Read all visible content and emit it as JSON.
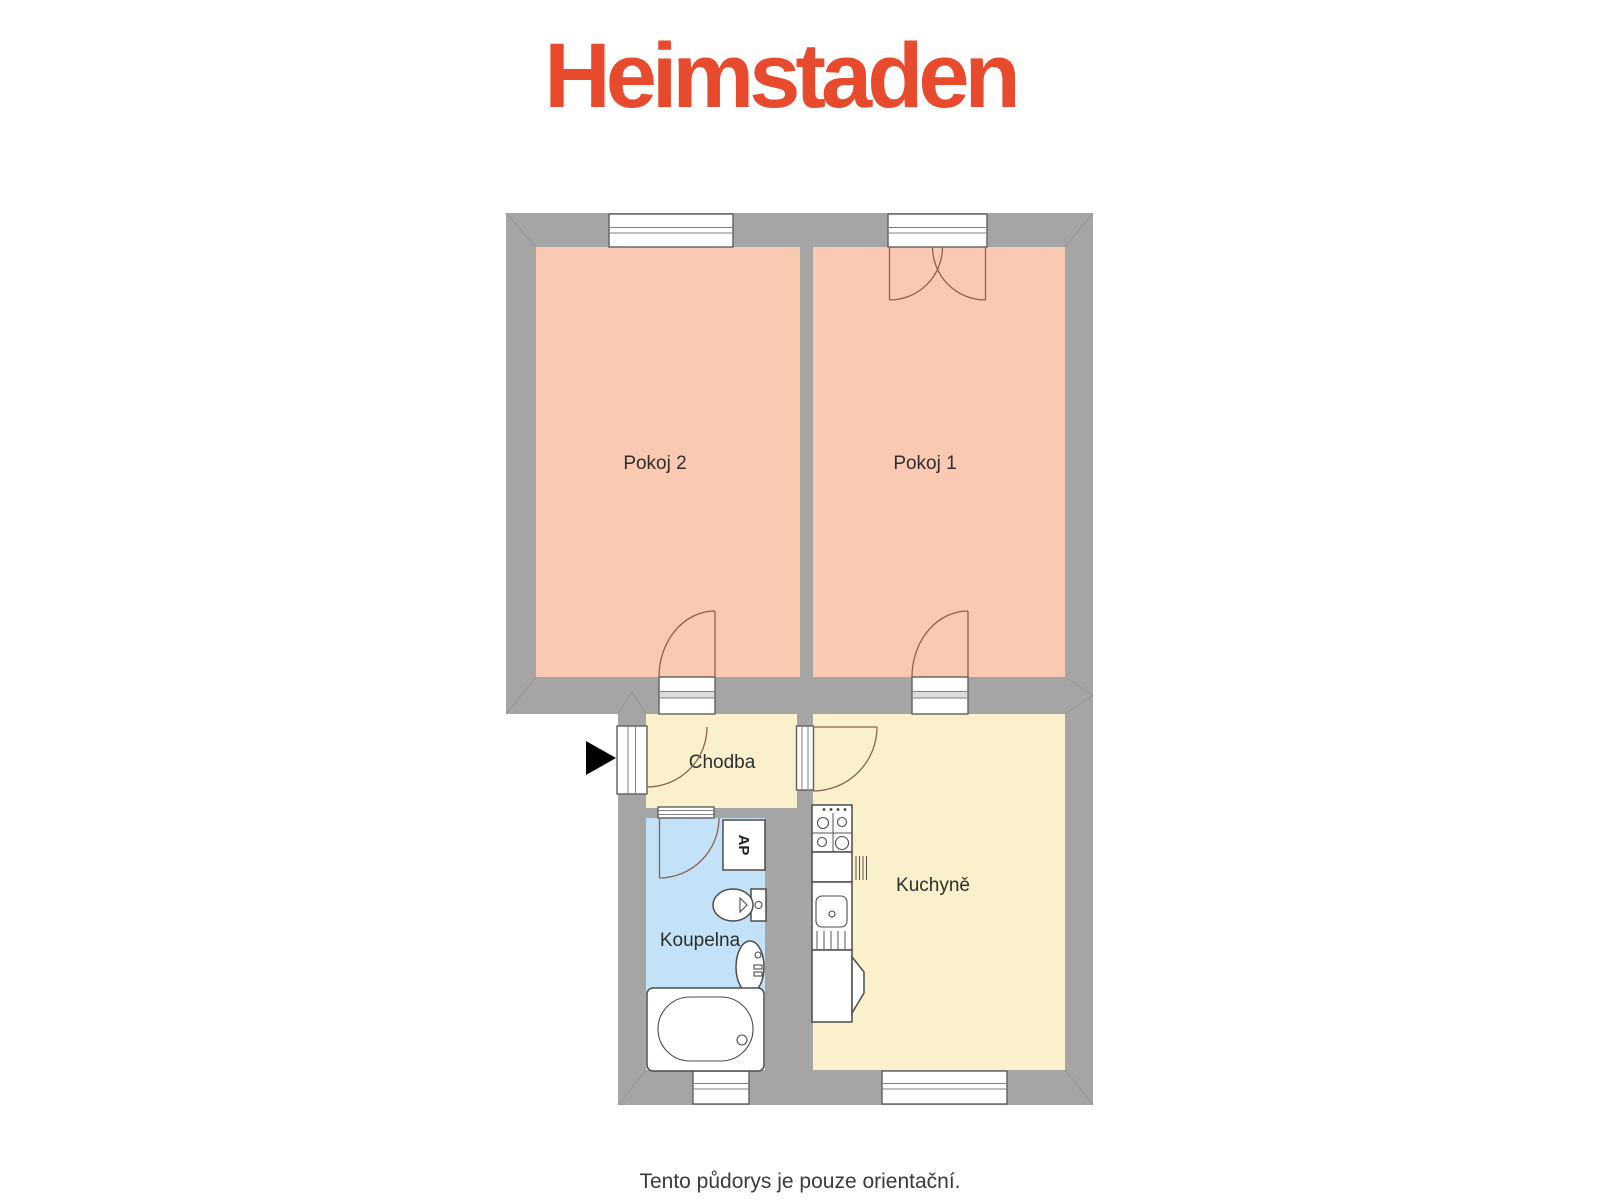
{
  "logo": {
    "text": "Heimstaden"
  },
  "floorplan": {
    "rooms": [
      {
        "id": "pokoj2",
        "label": "Pokoj 2"
      },
      {
        "id": "pokoj1",
        "label": "Pokoj 1"
      },
      {
        "id": "chodba",
        "label": "Chodba"
      },
      {
        "id": "koupelna",
        "label": "Koupelna"
      },
      {
        "id": "kuchyne",
        "label": "Kuchyně"
      }
    ],
    "appliances": {
      "washing_machine_label": "AP"
    }
  },
  "footer": {
    "note": "Tento půdorys je pouze orientační."
  },
  "colors": {
    "wall": "#a5a5a5",
    "warm": "#f9c9b1",
    "cream": "#faf0cc",
    "bath": "#c3e2f7",
    "logo": "#e84a2d",
    "ink": "#2e2e2e",
    "arc": "#8a6355"
  }
}
